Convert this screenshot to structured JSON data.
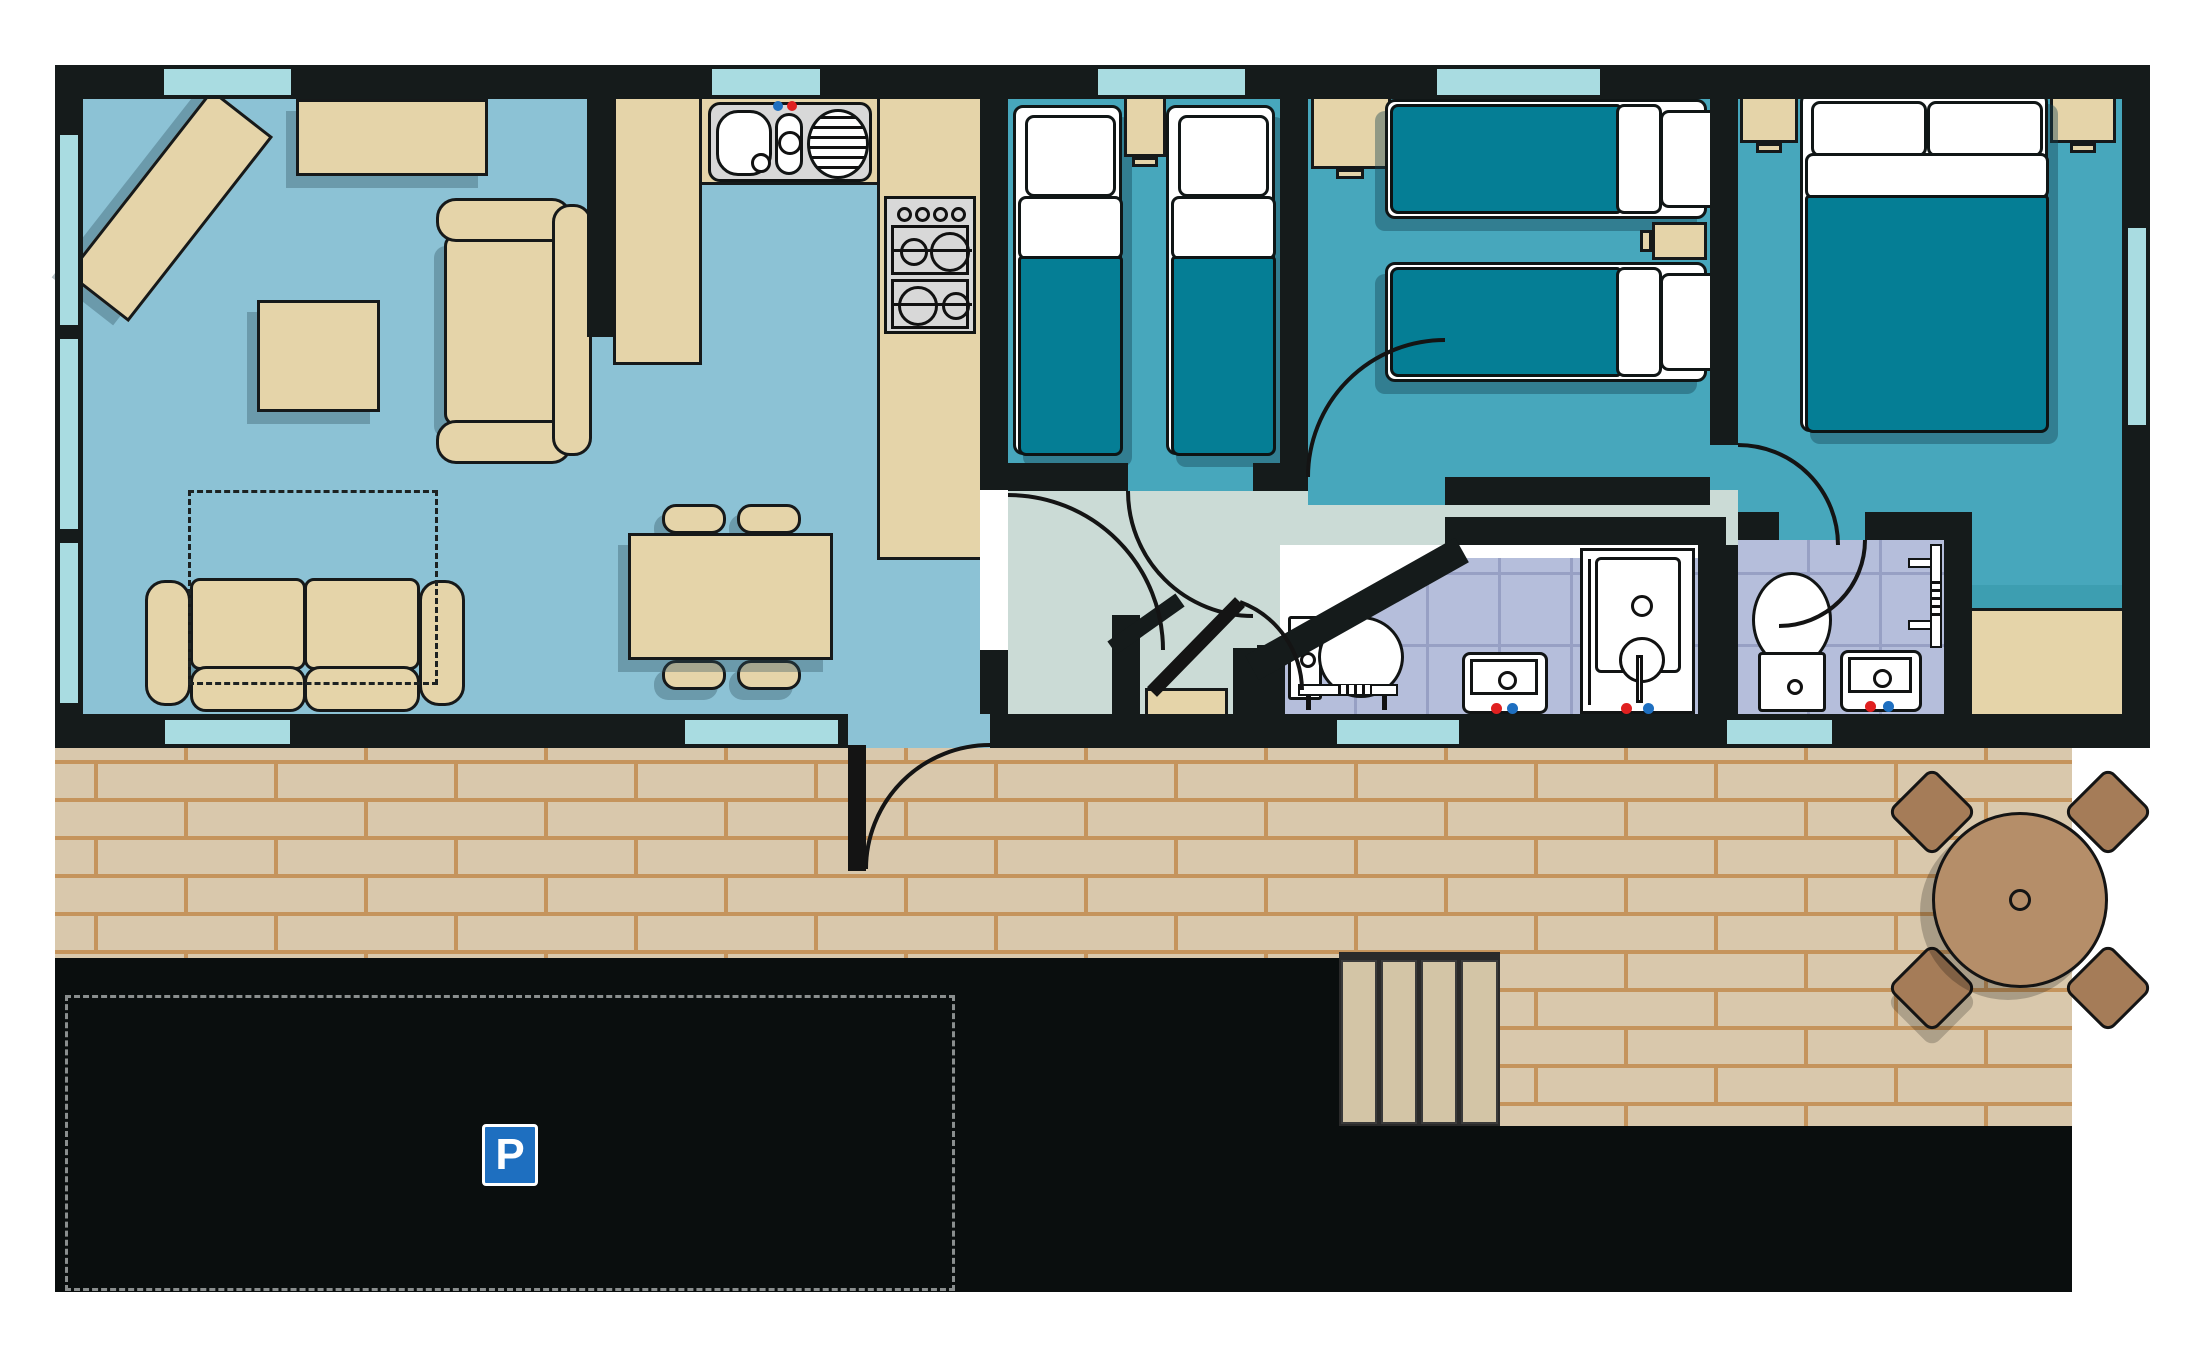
{
  "scene": {
    "type": "floor-plan",
    "subject": "holiday-lodge-caravan-plan",
    "orientation": "top-down"
  },
  "parking": {
    "sign_label": "P",
    "sign_color": "#1E6FC0",
    "surface_color": "#0A0E0E",
    "bay_marking_style": "dashed"
  },
  "palette": {
    "wall": "#151B1B",
    "lounge_floor": "#8CC2D5",
    "bedroom_floor": "#47A7BC",
    "hall_floor": "#CBDBD6",
    "bathroom_tile": "#B5BEDB",
    "tile_grout": "#97A0C4",
    "furniture_tan": "#E5D4A9",
    "bed_cover_teal": "#057E95",
    "window_glass": "#A9DCE1",
    "decking_brick": "#D9C8AC",
    "brick_mortar": "#C5945C",
    "garden_wood": "#B58E69",
    "tap_hot": "#E02020",
    "tap_cold": "#1E6FC0"
  },
  "rooms": [
    {
      "name": "lounge",
      "furniture": [
        "corner-media-unit",
        "sideboard",
        "armchair",
        "coffee-table",
        "sofa",
        "sofa-bed-outline"
      ]
    },
    {
      "name": "kitchen",
      "furniture": [
        "sink-drainer-unit",
        "four-burner-hob",
        "u-shaped-counter"
      ]
    },
    {
      "name": "dining-area",
      "furniture": [
        "dining-table"
      ],
      "chair_count": 4
    },
    {
      "name": "twin-bedroom-1",
      "furniture": [
        "single-bed",
        "single-bed",
        "bedside-unit"
      ],
      "bed_count": 2
    },
    {
      "name": "twin-bedroom-2",
      "furniture": [
        "single-bed",
        "single-bed",
        "bedside-unit",
        "wardrobe"
      ],
      "bed_count": 2
    },
    {
      "name": "master-bedroom",
      "furniture": [
        "double-bed",
        "bedside-cabinet-left",
        "bedside-cabinet-right",
        "wardrobe"
      ]
    },
    {
      "name": "bathroom",
      "fixtures": [
        "toilet",
        "towel-rail",
        "wash-basin",
        "shower-cubicle"
      ]
    },
    {
      "name": "ensuite",
      "fixtures": [
        "toilet",
        "wash-basin",
        "towel-ladder"
      ]
    },
    {
      "name": "hallway",
      "fixtures": [
        "airing-cupboard"
      ]
    },
    {
      "name": "outdoor",
      "features": [
        "brick-decking",
        "steps",
        "garden-table",
        "garden-chairs",
        "parking-bay"
      ],
      "garden_chair_count": 4
    }
  ]
}
